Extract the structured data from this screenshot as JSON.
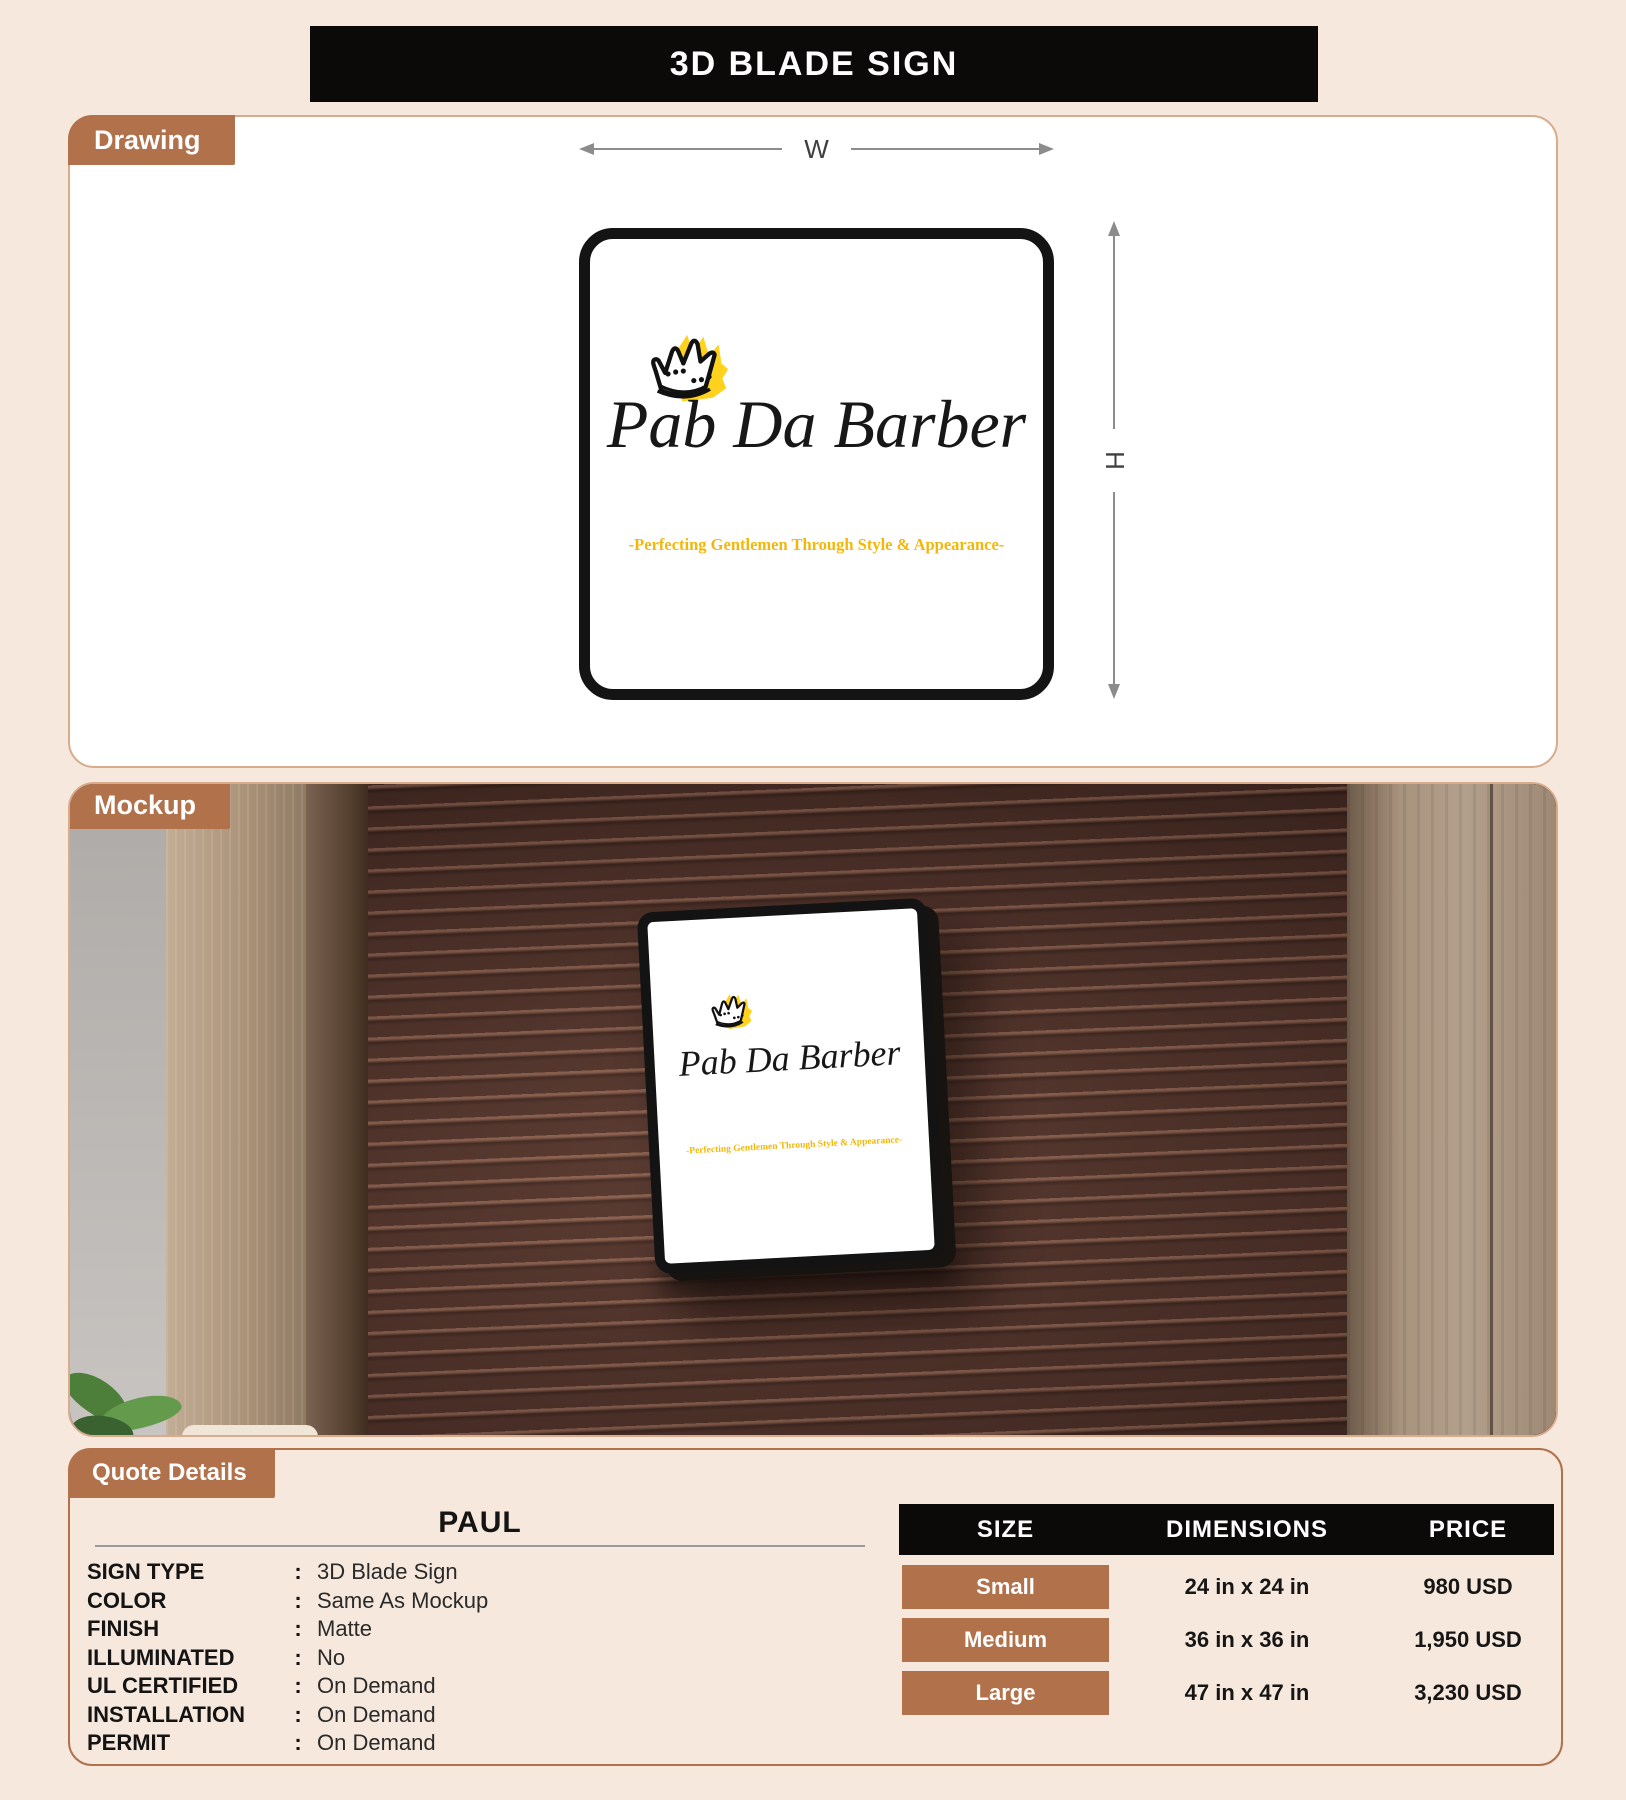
{
  "theme": {
    "page_bg": "#f6e8dc",
    "accent_brown": "#b0714b",
    "bar_black": "#0c0a09",
    "gold": "#f3b70a",
    "crown_yellow": "#ffd21e",
    "wall_brown": "#4c2e26",
    "panel_border": "#d8ab8c"
  },
  "title": "3D BLADE SIGN",
  "drawing": {
    "tab_label": "Drawing",
    "width_label": "W",
    "height_label": "H"
  },
  "mockup": {
    "tab_label": "Mockup"
  },
  "logo": {
    "brand": "Pab Da Barber",
    "tagline": "-Perfecting Gentlemen Through Style & Appearance-",
    "crown_icon": "crown-doodle"
  },
  "quote_details": {
    "tab_label": "Quote Details",
    "customer_name": "PAUL",
    "separator": ":",
    "specs": [
      {
        "label": "SIGN TYPE",
        "value": "3D Blade Sign"
      },
      {
        "label": "COLOR",
        "value": "Same As Mockup"
      },
      {
        "label": "FINISH",
        "value": "Matte"
      },
      {
        "label": "ILLUMINATED",
        "value": "No"
      },
      {
        "label": "UL CERTIFIED",
        "value": "On Demand"
      },
      {
        "label": "INSTALLATION",
        "value": "On Demand"
      },
      {
        "label": "PERMIT",
        "value": "On Demand"
      }
    ]
  },
  "pricing_table": {
    "headers": [
      "SIZE",
      "DIMENSIONS",
      "PRICE"
    ],
    "rows": [
      {
        "size": "Small",
        "dimensions": "24 in x 24 in",
        "price": "980 USD"
      },
      {
        "size": "Medium",
        "dimensions": "36 in x 36 in",
        "price": "1,950 USD"
      },
      {
        "size": "Large",
        "dimensions": "47 in x 47 in",
        "price": "3,230 USD"
      }
    ]
  }
}
